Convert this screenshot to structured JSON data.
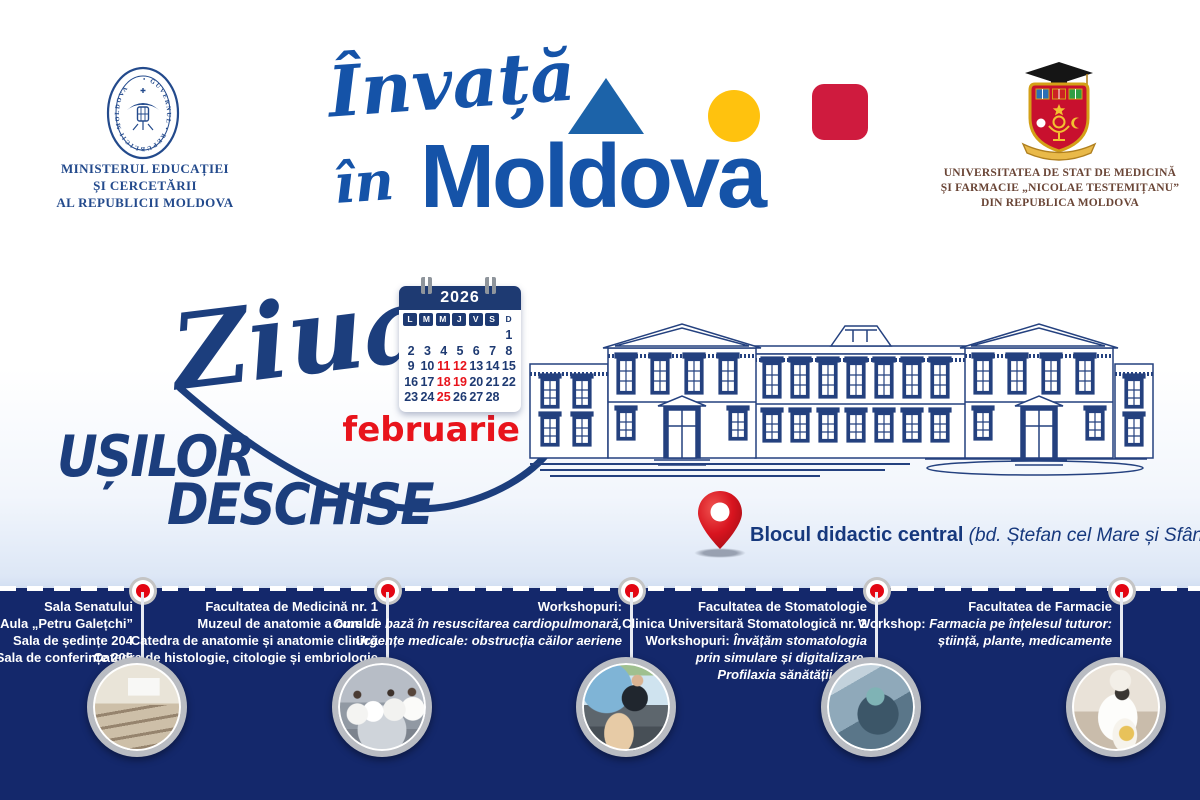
{
  "colors": {
    "brand_blue": "#1553a8",
    "title_navy": "#1c3e7d",
    "band_navy": "#14286b",
    "accent_red": "#e8141c",
    "marker_red": "#e30613",
    "shape_yellow": "#ffc20e",
    "shape_red": "#cf1b3e",
    "univ_maroon": "#6a4536"
  },
  "header": {
    "ministry": {
      "seal_text": "• GUVERNUL • REPUBLICII MOLDOVA",
      "line1": "MINISTERUL EDUCAȚIEI",
      "line2": "ȘI CERCETĂRII",
      "line3": "AL REPUBLICII MOLDOVA"
    },
    "brand": {
      "script_top": "Învață",
      "script_bottom": "în",
      "wordmark": "Moldova"
    },
    "university": {
      "line1": "UNIVERSITATEA DE STAT DE MEDICINĂ",
      "line2": "ȘI FARMACIE „NICOLAE TESTEMIȚANU”",
      "line3": "DIN REPUBLICA MOLDOVA"
    }
  },
  "event": {
    "title_script": "Ziua",
    "title_word1": "UȘILOR",
    "title_word2": "DESCHISE",
    "month": "februarie",
    "calendar": {
      "year": "2026",
      "day_headers": [
        "L",
        "M",
        "M",
        "J",
        "V",
        "S",
        "D"
      ],
      "cells": [
        "",
        "",
        "",
        "",
        "",
        "",
        "1",
        "2",
        "3",
        "4",
        "5",
        "6",
        "7",
        "8",
        "9",
        "10",
        "11",
        "12",
        "13",
        "14",
        "15",
        "16",
        "17",
        "18",
        "19",
        "20",
        "21",
        "22",
        "23",
        "24",
        "25",
        "26",
        "27",
        "28",
        ""
      ],
      "highlighted_days": [
        "11",
        "12",
        "18",
        "19",
        "25"
      ]
    },
    "location": {
      "name": "Blocul didactic central",
      "address": " (bd. Ștefan cel Mare și Sfânt, 165)"
    }
  },
  "timeline": {
    "stops": [
      {
        "l1": "Sala Senatului",
        "l2": "Aula „Petru Galețchi”",
        "l3": "Sala de ședințe 204",
        "l4": "Sala de conferințe 205"
      },
      {
        "l1": "Facultatea de Medicină nr. 1",
        "l2": "Muzeul de anatomie a omului",
        "l3": "Catedra de anatomie și anatomie clinică",
        "l4": "Catedra de histologie, citologie și embriologie"
      },
      {
        "l1": "Workshopuri:",
        "l2": "Curs de bază în resuscitarea cardiopulmonară,",
        "l3": "Urgențe medicale: obstrucția căilor aeriene"
      },
      {
        "l1": "Facultatea de Stomatologie",
        "l2": "Clinica Universitară Stomatologică nr. 2",
        "l3a": "Workshopuri: ",
        "l3b": "Învățăm stomatologia",
        "l4": "prin simulare și digitalizare,",
        "l5": "Profilaxia sănătății orale"
      },
      {
        "l1": "Facultatea de Farmacie",
        "l2a": "Workshop: ",
        "l2b": "Farmacia pe înțelesul tuturor:",
        "l3": "știință, plante, medicamente"
      }
    ]
  }
}
